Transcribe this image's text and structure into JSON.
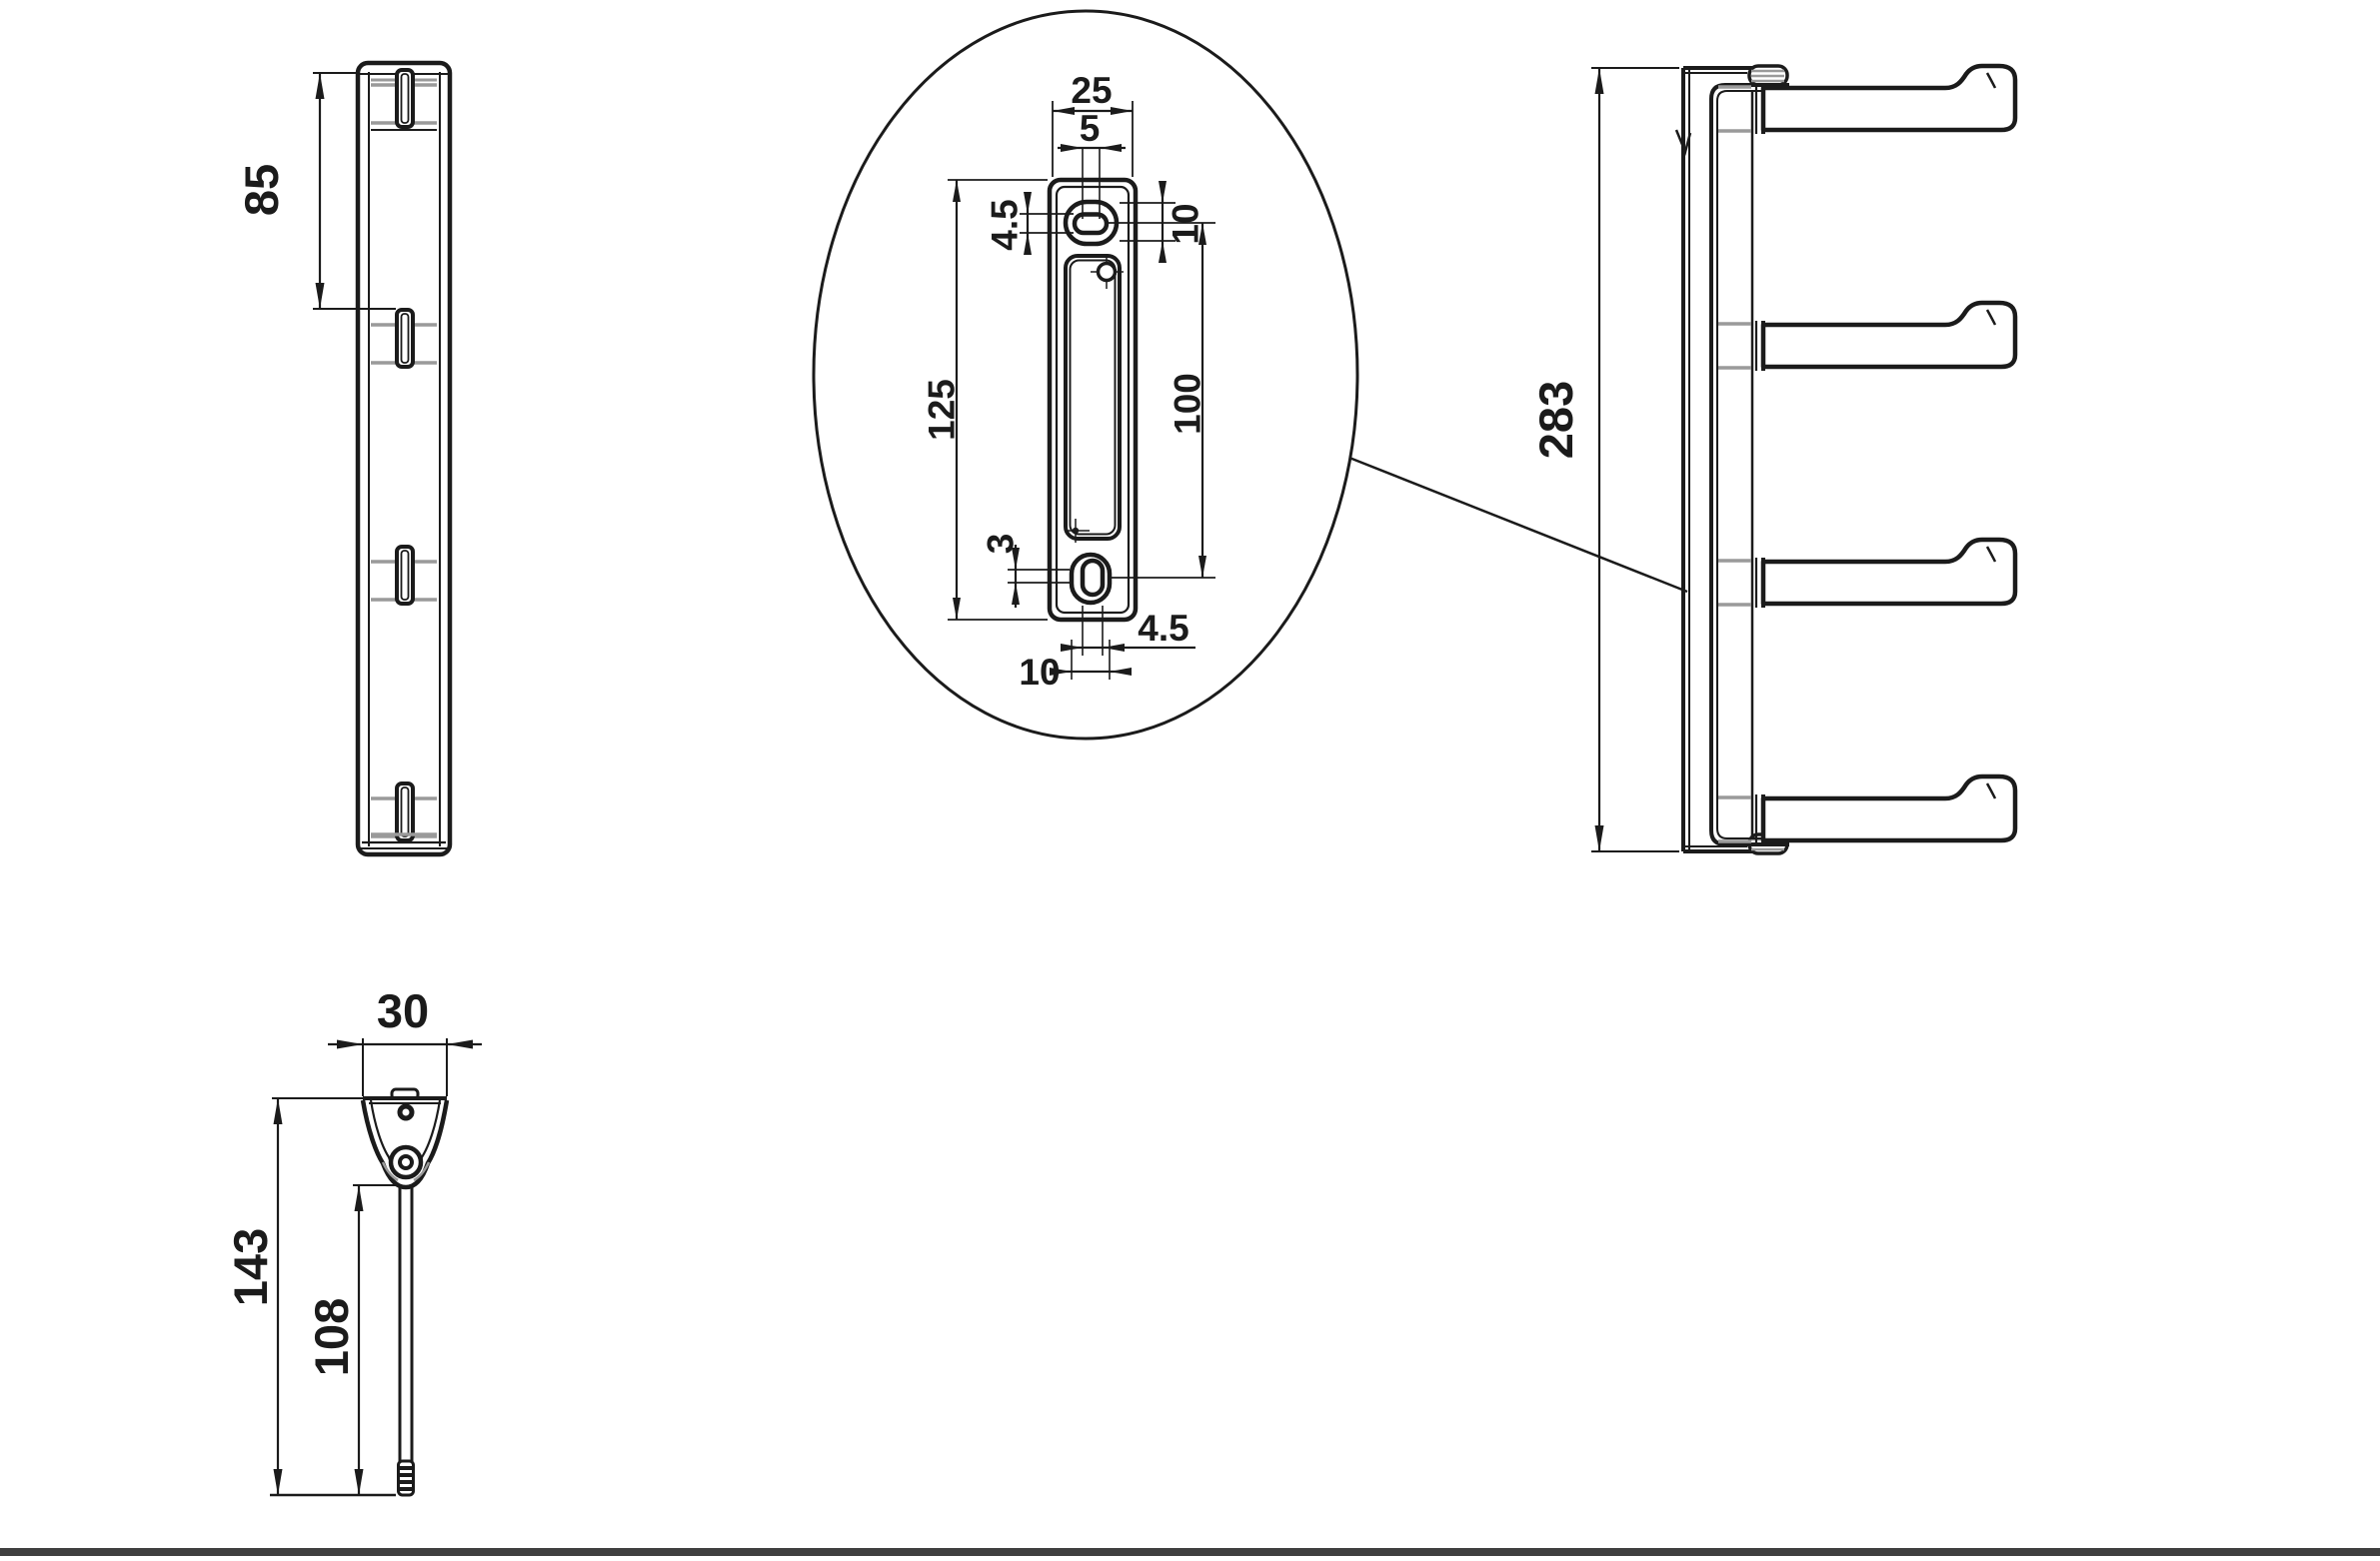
{
  "drawing": {
    "type": "technical-dimension-drawing",
    "part": "wall rail with swivel hook arms",
    "colors": {
      "line": "#1b1b1b",
      "accent_gray": "#9a9a9a",
      "footer_bar": "#3f3f3f"
    },
    "views": {
      "rail_profile": {
        "height_to_first_hook": "85"
      },
      "plate_detail": {
        "plate_width": "25",
        "slot_width": "5",
        "slot_height": "4.5",
        "top_countersink": "10",
        "plate_height": "125",
        "hole_spacing": "100",
        "bottom_offset": "3",
        "bottom_slot_width": "4.5",
        "bottom_countersink": "10"
      },
      "assembly_profile": {
        "overall_height": "283"
      },
      "arm_detail": {
        "bracket_width": "30",
        "overall_length": "143",
        "rod_length": "108"
      }
    }
  }
}
